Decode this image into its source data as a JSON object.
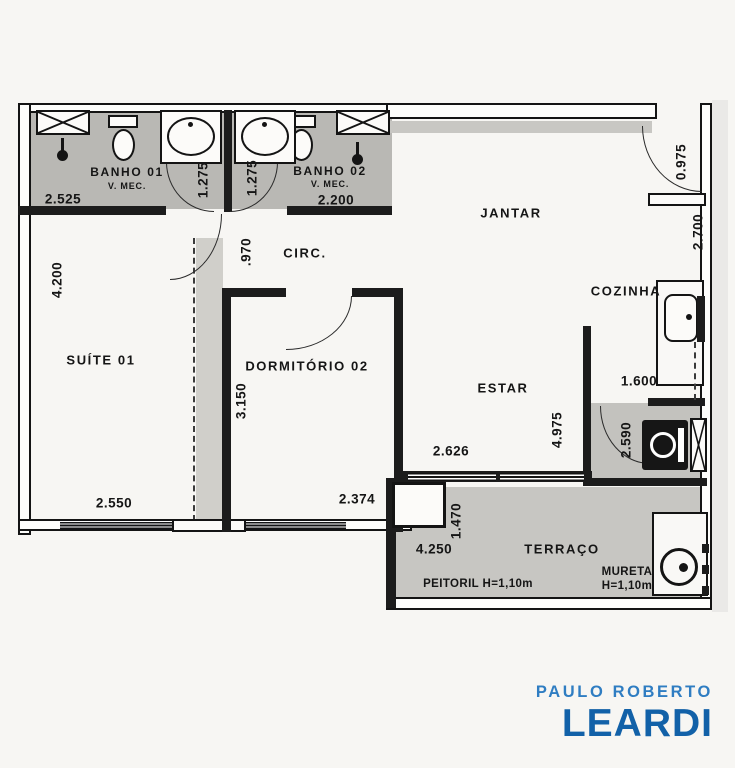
{
  "plan": {
    "rooms": {
      "banho01": {
        "name": "BANHO 01",
        "note": "V. MEC."
      },
      "banho02": {
        "name": "BANHO 02",
        "note": "V. MEC."
      },
      "jantar": {
        "name": "JANTAR"
      },
      "cozinha": {
        "name": "COZINHA"
      },
      "suite01": {
        "name": "SUÍTE 01"
      },
      "circ": {
        "name": "CIRC."
      },
      "dormitorio02": {
        "name": "DORMITÓRIO 02"
      },
      "estar": {
        "name": "ESTAR"
      },
      "terraco": {
        "name": "TERRAÇO"
      }
    },
    "dims": {
      "banho01_width": "2.525",
      "banho01_door": "1.275",
      "banho02_door": "1.275",
      "banho02_width": "2.200",
      "entry_door": "0.975",
      "entry_side": "2.700",
      "suite_depth": "4.200",
      "suite_width": "2.550",
      "circ_width": ".970",
      "dorm_depth": "3.150",
      "dorm_width": "2.374",
      "cozinha_width": "1.600",
      "estar_depth": "4.975",
      "estar_width": "2.626",
      "service_width": "2.590",
      "terraco_width": "4.250",
      "terraco_depth": "1.470"
    },
    "notes": {
      "peitoril": "PEITORIL H=1,10m",
      "mureta_line1": "MURETA",
      "mureta_line2": "H=1,10m"
    }
  },
  "branding": {
    "line1": "PAULO ROBERTO",
    "line2": "LEARDI"
  },
  "colors": {
    "wall": "#1c1c1c",
    "bath_floor": "#b9b8b4",
    "terrace_floor": "#c7c6c2",
    "service_floor": "#c3c2be",
    "wardrobe_strip": "#d0cfca",
    "brand_light": "#2f7dc2",
    "brand_dark": "#1261a8",
    "paper": "#f7f6f3"
  }
}
